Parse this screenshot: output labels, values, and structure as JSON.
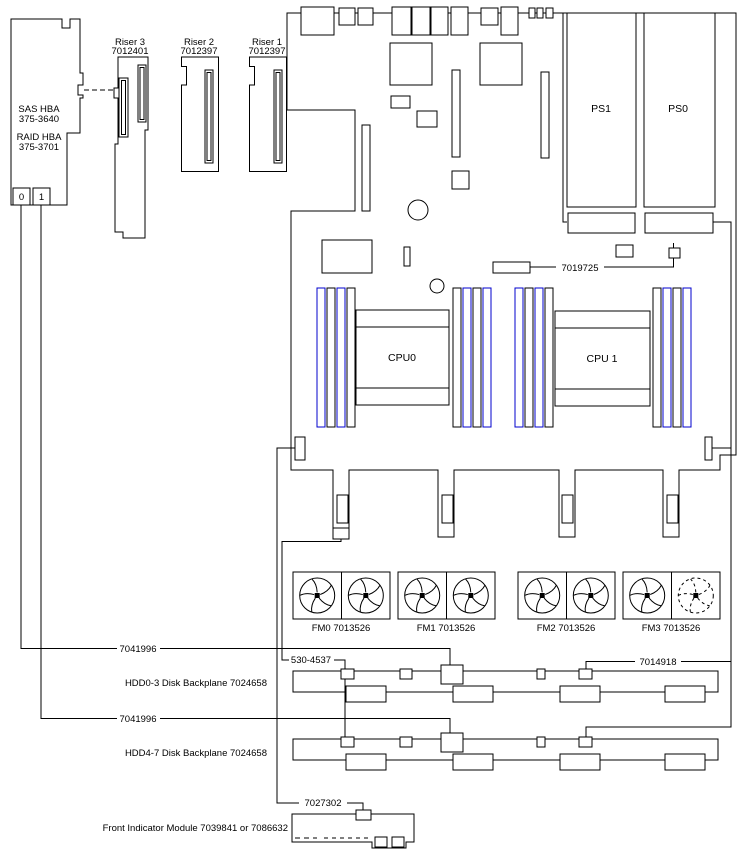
{
  "hba": {
    "label_sas": "SAS HBA",
    "part_sas": "375-3640",
    "label_raid": "RAID HBA",
    "part_raid": "375-3701",
    "port0": "0",
    "port1": "1"
  },
  "risers": [
    {
      "name": "Riser 3",
      "part": "7012401"
    },
    {
      "name": "Riser 2",
      "part": "7012397"
    },
    {
      "name": "Riser 1",
      "part": "7012397"
    }
  ],
  "psu": {
    "ps1": "PS1",
    "ps0": "PS0"
  },
  "cpu": {
    "cpu0": "CPU0",
    "cpu1": "CPU 1"
  },
  "cables": {
    "fan_power": "7019725",
    "sas": "7041996",
    "aux": "530-4537",
    "bp_power": "7014918",
    "front_ind": "7027302"
  },
  "fans": [
    {
      "label": "FM0 7013526"
    },
    {
      "label": "FM1 7013526"
    },
    {
      "label": "FM2 7013526"
    },
    {
      "label": "FM3 7013526"
    }
  ],
  "backplanes": {
    "hdd03": "HDD0-3 Disk Backplane 7024658",
    "hdd47": "HDD4-7 Disk Backplane 7024658"
  },
  "front_indicator": {
    "label": "Front Indicator Module 7039841 or 7086632"
  }
}
